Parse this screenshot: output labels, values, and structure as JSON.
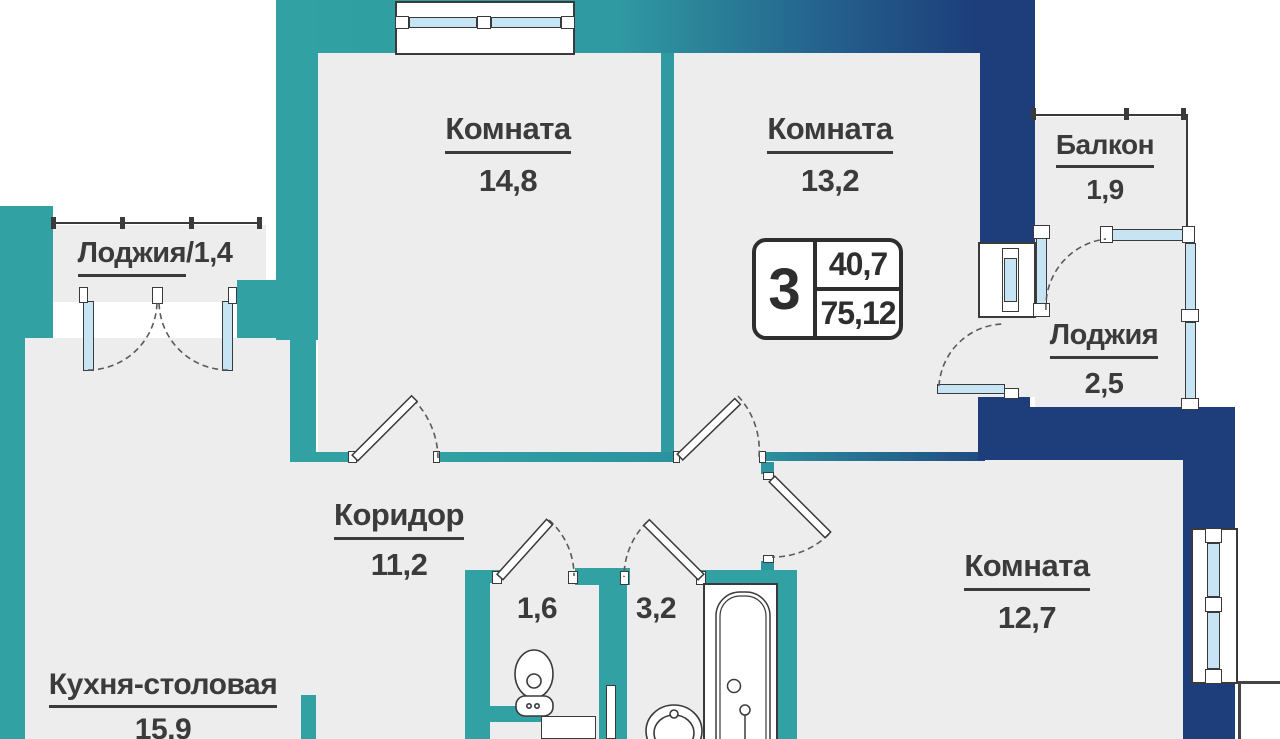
{
  "badge": {
    "rooms_count": "3",
    "area_top": "40,7",
    "area_bottom": "75,12"
  },
  "rooms": {
    "room_14_8": {
      "name": "Комната",
      "area": "14,8"
    },
    "room_13_2": {
      "name": "Комната",
      "area": "13,2"
    },
    "room_12_7": {
      "name": "Комната",
      "area": "12,7"
    },
    "corridor": {
      "name": "Коридор",
      "area": "11,2"
    },
    "kitchen": {
      "name": "Кухня-столовая",
      "area": "15,9"
    },
    "balcony": {
      "name": "Балкон",
      "area": "1,9"
    },
    "loggia_small": {
      "name": "Лоджия",
      "area_suffix": "/1,4"
    },
    "loggia_large": {
      "name": "Лоджия",
      "area": "2,5"
    },
    "wc": {
      "area": "1,6"
    },
    "bathroom": {
      "area": "3,2"
    }
  },
  "colors": {
    "wall_teal": "#31a1a3",
    "wall_navy": "#1d3e7b",
    "floor_gray": "#ededed",
    "glass_blue": "#c7e4f5",
    "line_dark": "#3a3a3a"
  }
}
